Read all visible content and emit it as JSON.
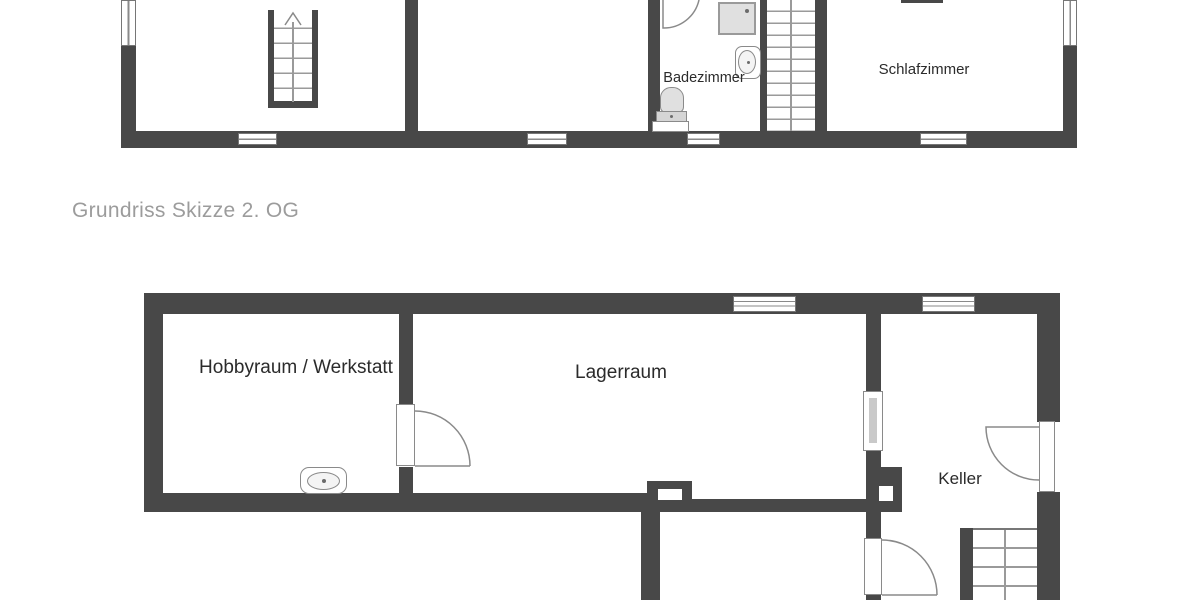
{
  "caption": "Grundriss Skizze 2. OG",
  "rooms": {
    "badezimmer": "Badezimmer",
    "schlafzimmer": "Schlafzimmer",
    "hobbyraum": "Hobbyraum / Werkstatt",
    "lagerraum": "Lagerraum",
    "keller": "Keller"
  },
  "colors": {
    "wall": "#484848",
    "outline": "#8a8a8a",
    "fixture": "#e0e0e0",
    "label": "#2b2b2b",
    "caption": "#9c9c9c",
    "background": "#ffffff"
  }
}
